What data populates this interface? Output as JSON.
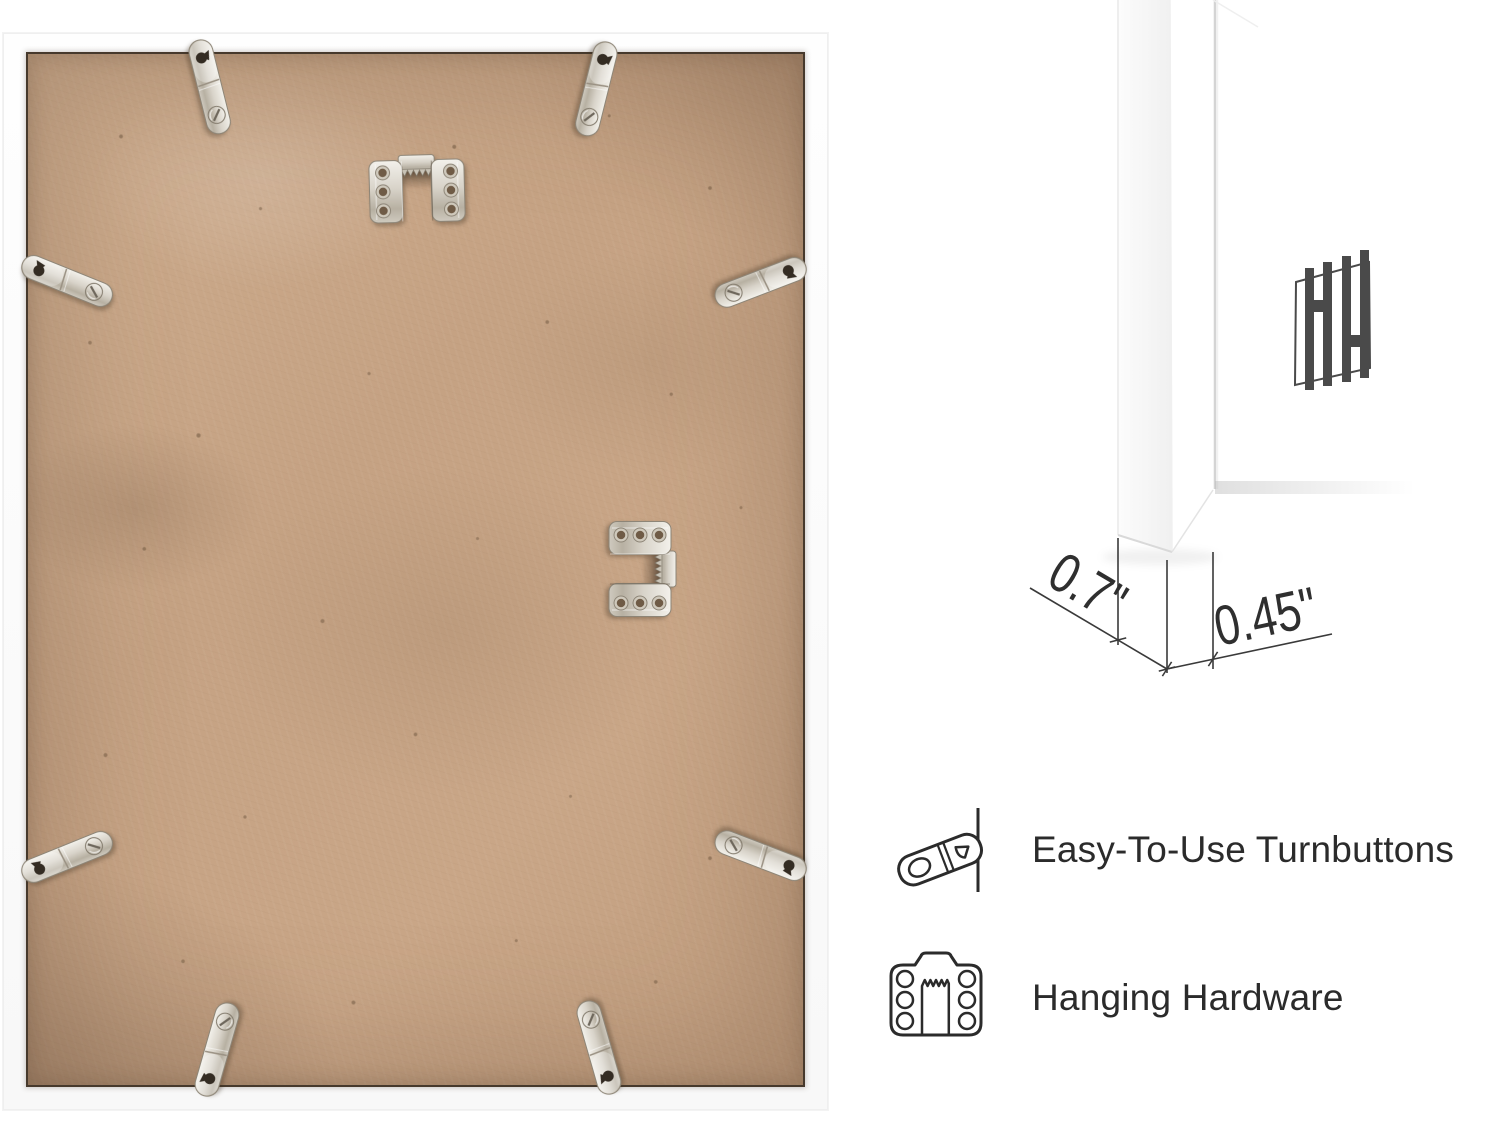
{
  "page": {
    "background_color": "#ffffff"
  },
  "back_photo": {
    "description": "Back view of a white picture frame with MDF backing board",
    "frame_color": "#ffffff",
    "backing_color": "#c7a486",
    "turnbutton_count": 8,
    "sawtooth_hanger_count": 2
  },
  "corner_closeup": {
    "description": "Close-up of white frame corner profile with mat",
    "logo_icon": "hh-monogram-logo",
    "logo_color": "#4a4a4a"
  },
  "dimensions": {
    "depth_label": "0.7\"",
    "face_label": "0.45\""
  },
  "features": [
    {
      "icon": "turnbutton-icon",
      "label": "Easy-To-Use Turnbuttons"
    },
    {
      "icon": "hanging-hardware-icon",
      "label": "Hanging Hardware"
    }
  ],
  "colors": {
    "text": "#2b2b2b",
    "outline": "#2b2b2b",
    "dimension_text": "#2f2f2f",
    "metal": "#d8d3c9",
    "seam": "#46392c"
  }
}
